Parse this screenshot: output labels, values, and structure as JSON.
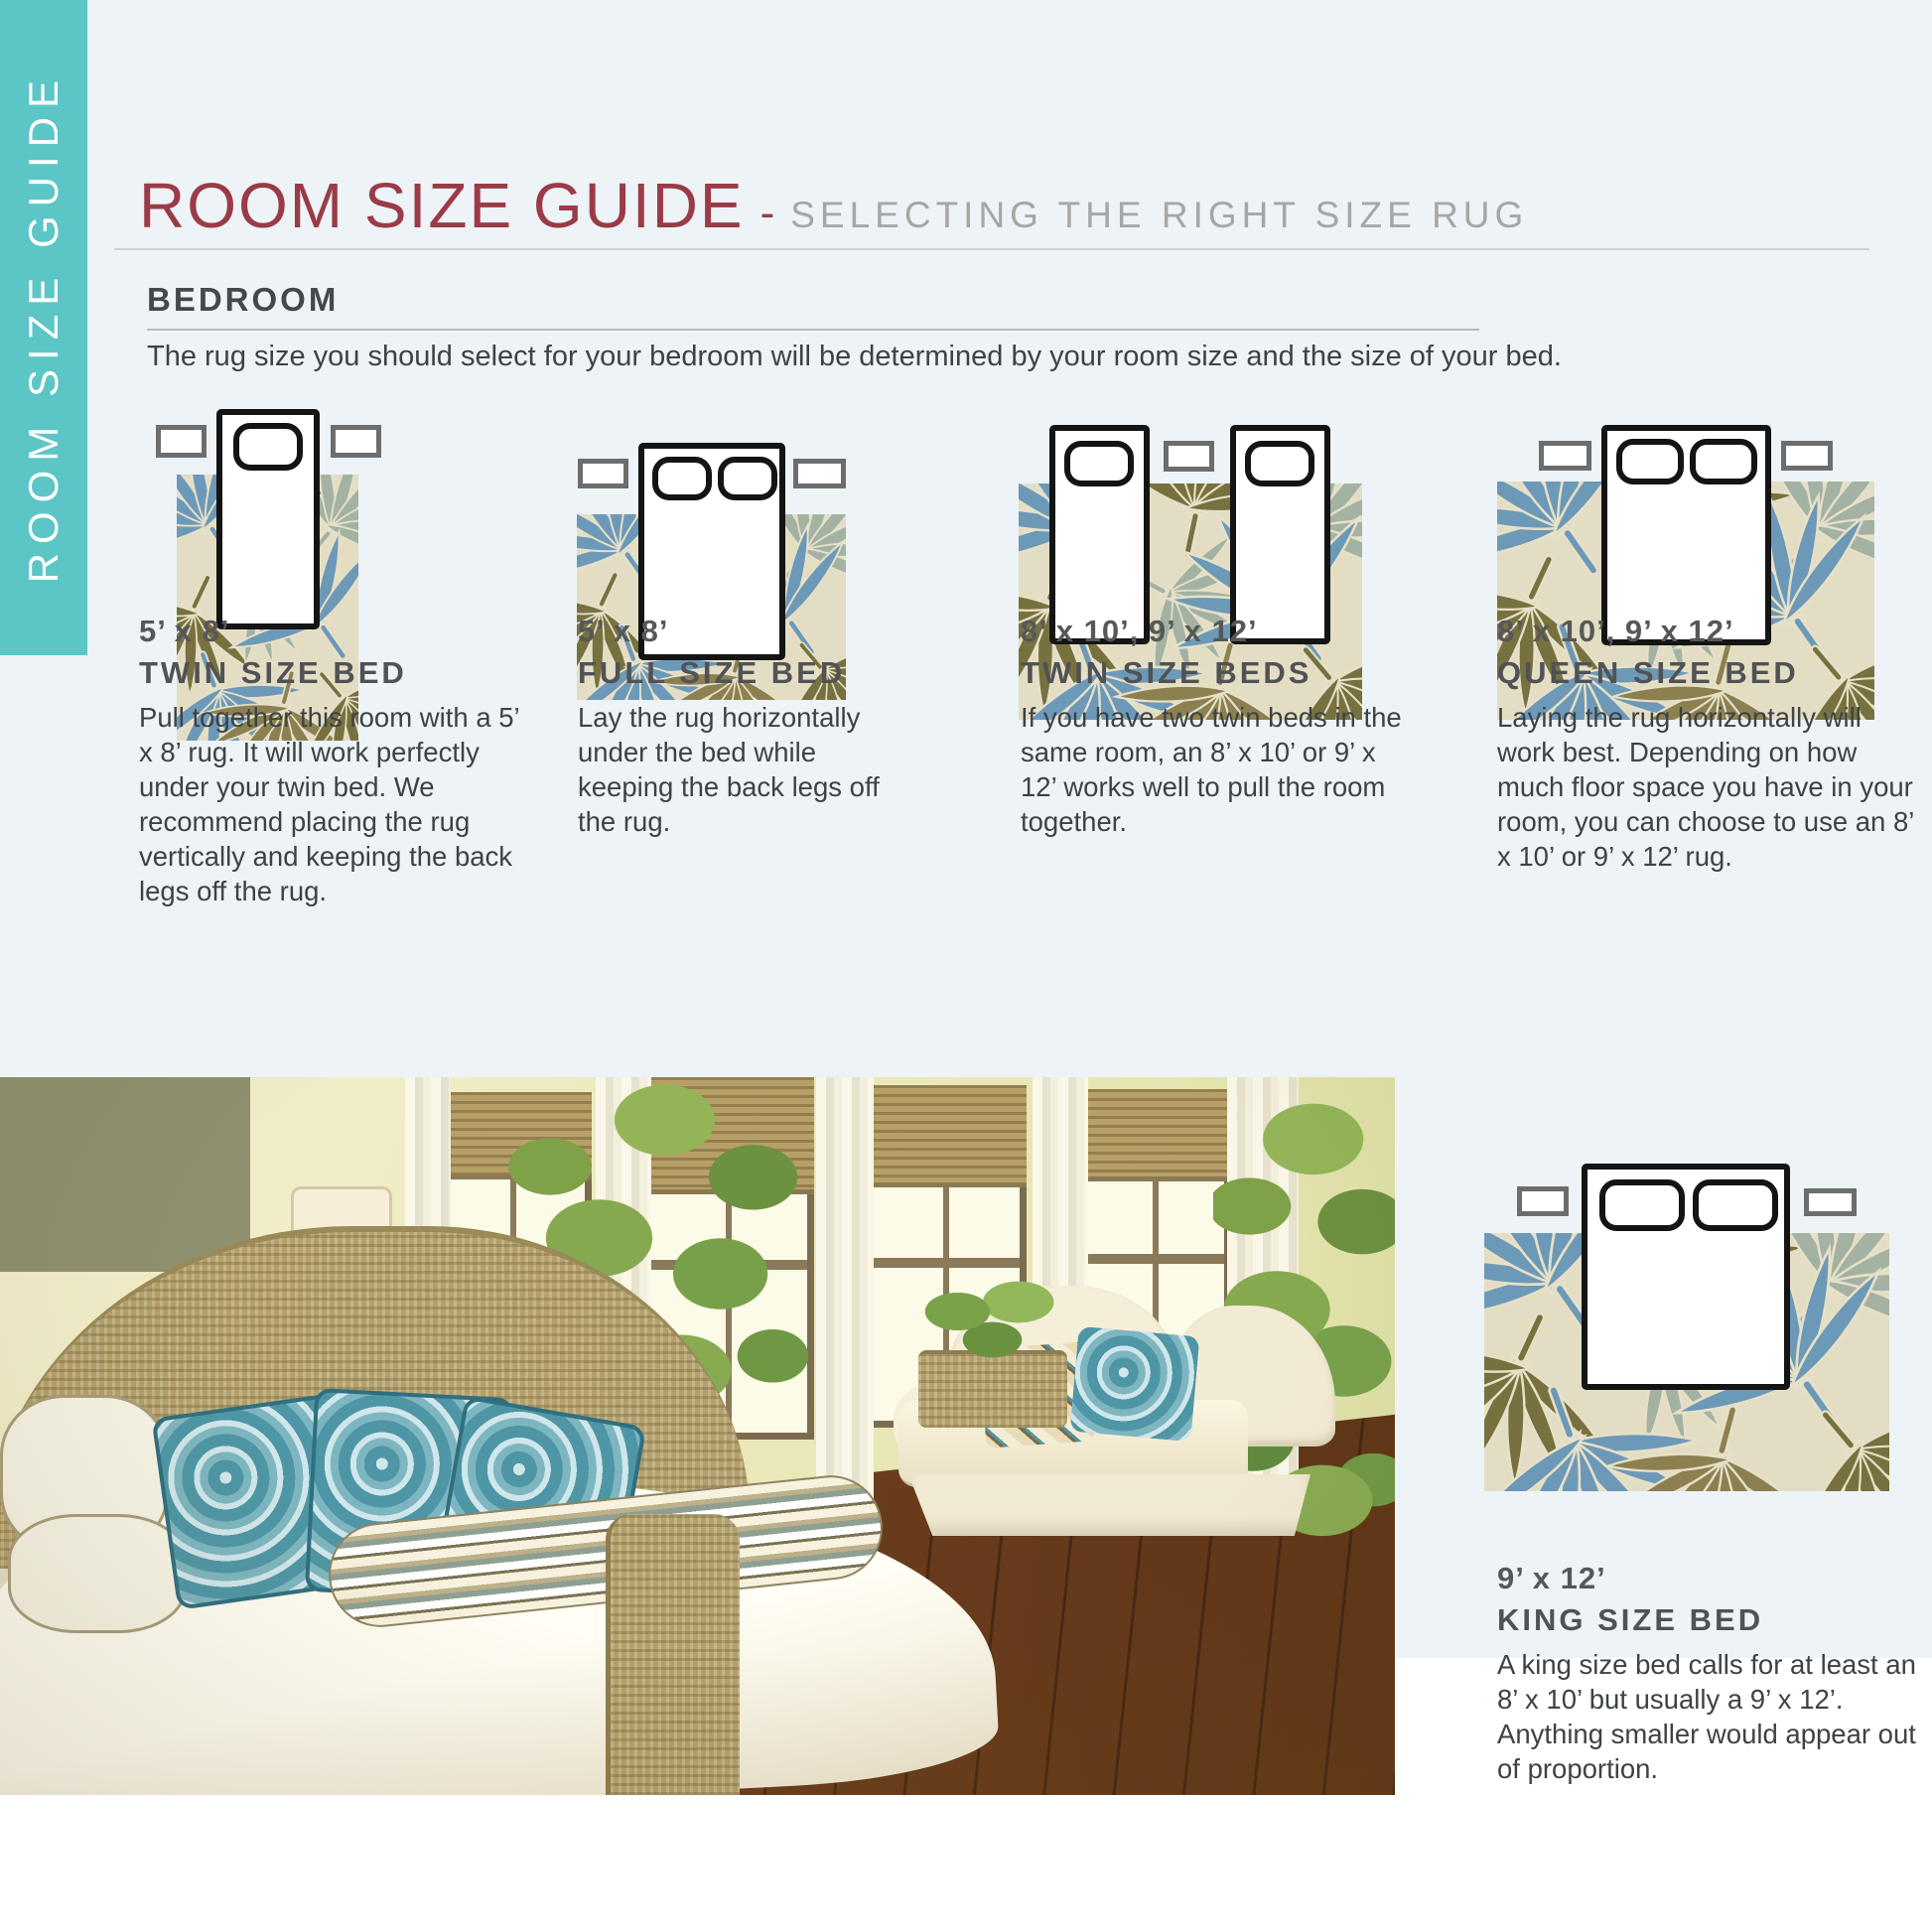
{
  "page": {
    "sidebar_label": "ROOM SIZE GUIDE",
    "title": "ROOM SIZE GUIDE",
    "separator": "-",
    "subtitle": "SELECTING THE RIGHT SIZE RUG",
    "section": {
      "heading": "BEDROOM",
      "intro": "The rug size you should select for your bedroom will be determined by your room size and the size of your bed."
    }
  },
  "guides": [
    {
      "size": "5’ x 8’",
      "bed": "TWIN SIZE BED",
      "desc": "Pull together this room with a 5’ x 8’ rug. It will work perfectly under your twin bed. We recommend placing the rug vertically and keeping the back legs off the rug."
    },
    {
      "size": "5’ x 8’",
      "bed": "FULL SIZE BED",
      "desc": "Lay the rug horizontally under the bed while keeping the back legs off the rug."
    },
    {
      "size": "8’ x 10’, 9’ x 12’",
      "bed": "TWIN SIZE BEDS",
      "desc": "If you have two twin beds in the same room, an 8’ x 10’ or 9’ x 12’ works well to pull the room together."
    },
    {
      "size": "8’ x 10’, 9’ x 12’",
      "bed": "QUEEN SIZE BED",
      "desc": "Laying the rug horizontally will work best. Depending on how much floor space you have in your room, you can choose to use an 8’ x 10’ or 9’ x 12’ rug."
    },
    {
      "size": "9’ x 12’",
      "bed": "KING SIZE BED",
      "desc": "A king size bed calls for at least an 8’ x 10’ but usually a 9’ x 12’. Anything smaller would appear out of proportion."
    }
  ],
  "colors": {
    "accent_teal": "#5bc6c5",
    "title_maroon": "#9a3b47",
    "subtitle_gray": "#a6a6a6",
    "heading_dark": "#505255",
    "body_text": "#3d4245",
    "band_background": "#edf3f6",
    "rug_cream": "#e3ddc4",
    "leaf_blue": "#6d99b8",
    "leaf_olive": "#77713f",
    "leaf_sage": "#a3b2a2",
    "leaf_brown": "#8d8050"
  }
}
